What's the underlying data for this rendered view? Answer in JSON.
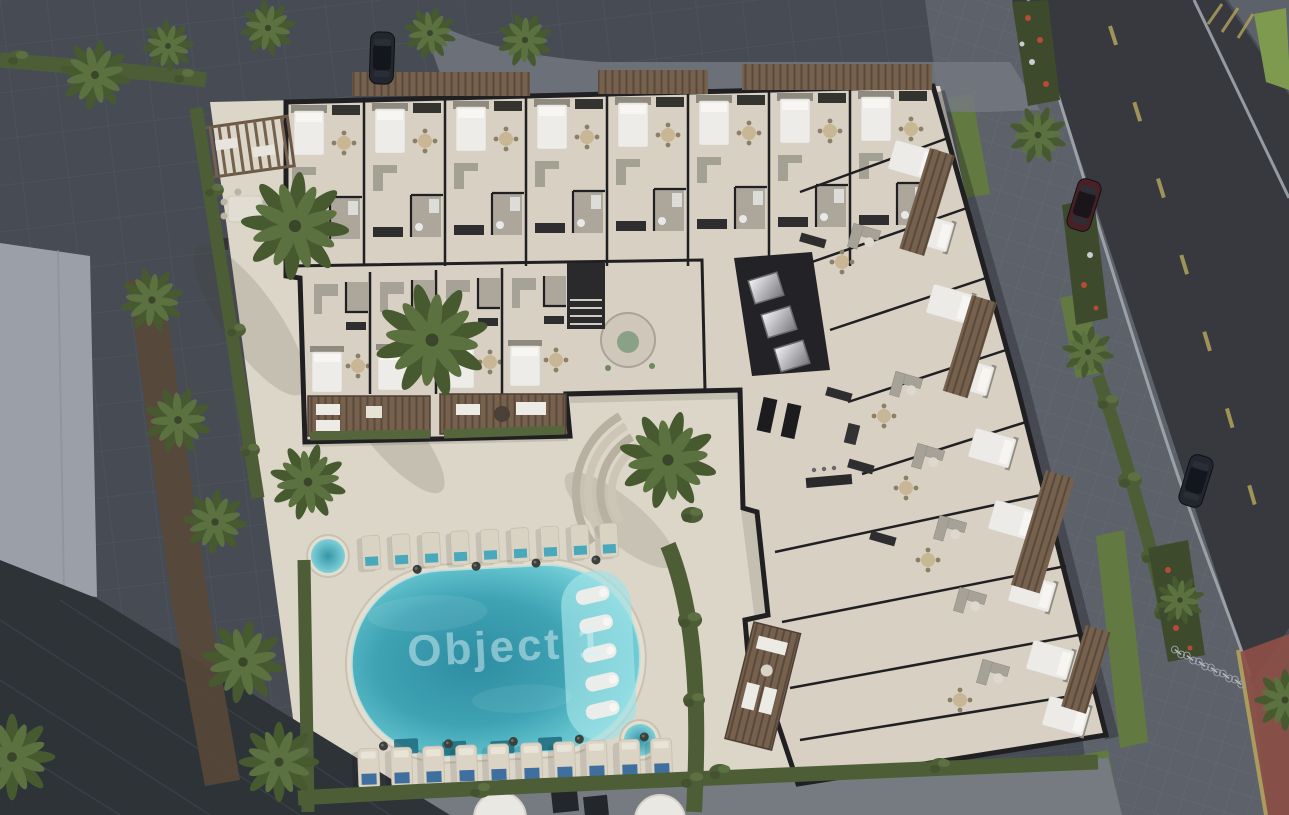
{
  "watermark": {
    "text": "Object 1"
  },
  "colors": {
    "plaza": "#474c54",
    "asphalt": "#37393e",
    "sidewalk": "#5d626a",
    "sidewalk_light": "#767b82",
    "deck": "#dcd6c8",
    "floor": "#d7d0c3",
    "wall": "#202023",
    "wood": "#75614e",
    "wood_dark": "#5a4939",
    "hedge": "#4d5e37",
    "palm_dark": "#46592f",
    "palm_light": "#5c7140",
    "grass": "#627a42",
    "grass_bright": "#7d9a4e",
    "dirt": "#584838",
    "pool_deep": "#2e8da1",
    "pool_mid": "#3fa3b4",
    "pool_pale": "#98e0e4",
    "pool_shelf": "#9fe3e7",
    "watermark": "#d8f1f7",
    "towel_blue": "#3e6f9e",
    "towel_aqua": "#49a8bc",
    "flower_red": "#b84a38",
    "red_pavement": "#8c4f47",
    "lane_yellow": "#b3a35c",
    "line_white": "#a7adb3",
    "car_dark": "#23262e",
    "car_red": "#4a2027",
    "roof_light": "#9ba0a8",
    "roof_dark": "#2e3338",
    "furn_white": "#edece8",
    "furn_gray": "#a6a298"
  },
  "scene": {
    "setting": "Aerial dusk 3D render of an L-shaped residential building shown as a cutaway furnished floor plan, with a landscaped pool courtyard, neighboring rooftops and a street with parked cars",
    "building": {
      "shape": "L-shaped",
      "wings": 2,
      "top_wing_units": 8,
      "right_wing_units": 9,
      "annex_units": 4,
      "elevators": 3,
      "stairwells": 2,
      "amenities": [
        "reception lounge",
        "gym",
        "pergola lounge",
        "outdoor dining"
      ]
    },
    "pool_area": {
      "main_pools": 1,
      "round_plunge_pools": 2,
      "in_pool_loungers": 5,
      "sun_loungers_south_row": 10,
      "sun_loungers_north_row": 9,
      "side_tables": 9,
      "curved_step_arcs": 4,
      "balcony_terraces": 2
    },
    "landscape": {
      "palm_trees": 19,
      "hedge_rows": 7,
      "flower_beds": 3,
      "grass_strips": 5,
      "dirt_beds": 1
    },
    "street": {
      "roads": 1,
      "parked_cars": 3,
      "bicycles": 6,
      "marking_center": "dashed yellow",
      "marking_edges": "solid white",
      "special_lane": "red paved strip"
    },
    "neighbors": {
      "rooftops": [
        "light gray building (west)",
        "dark ribbed roof (south-west)"
      ]
    }
  }
}
